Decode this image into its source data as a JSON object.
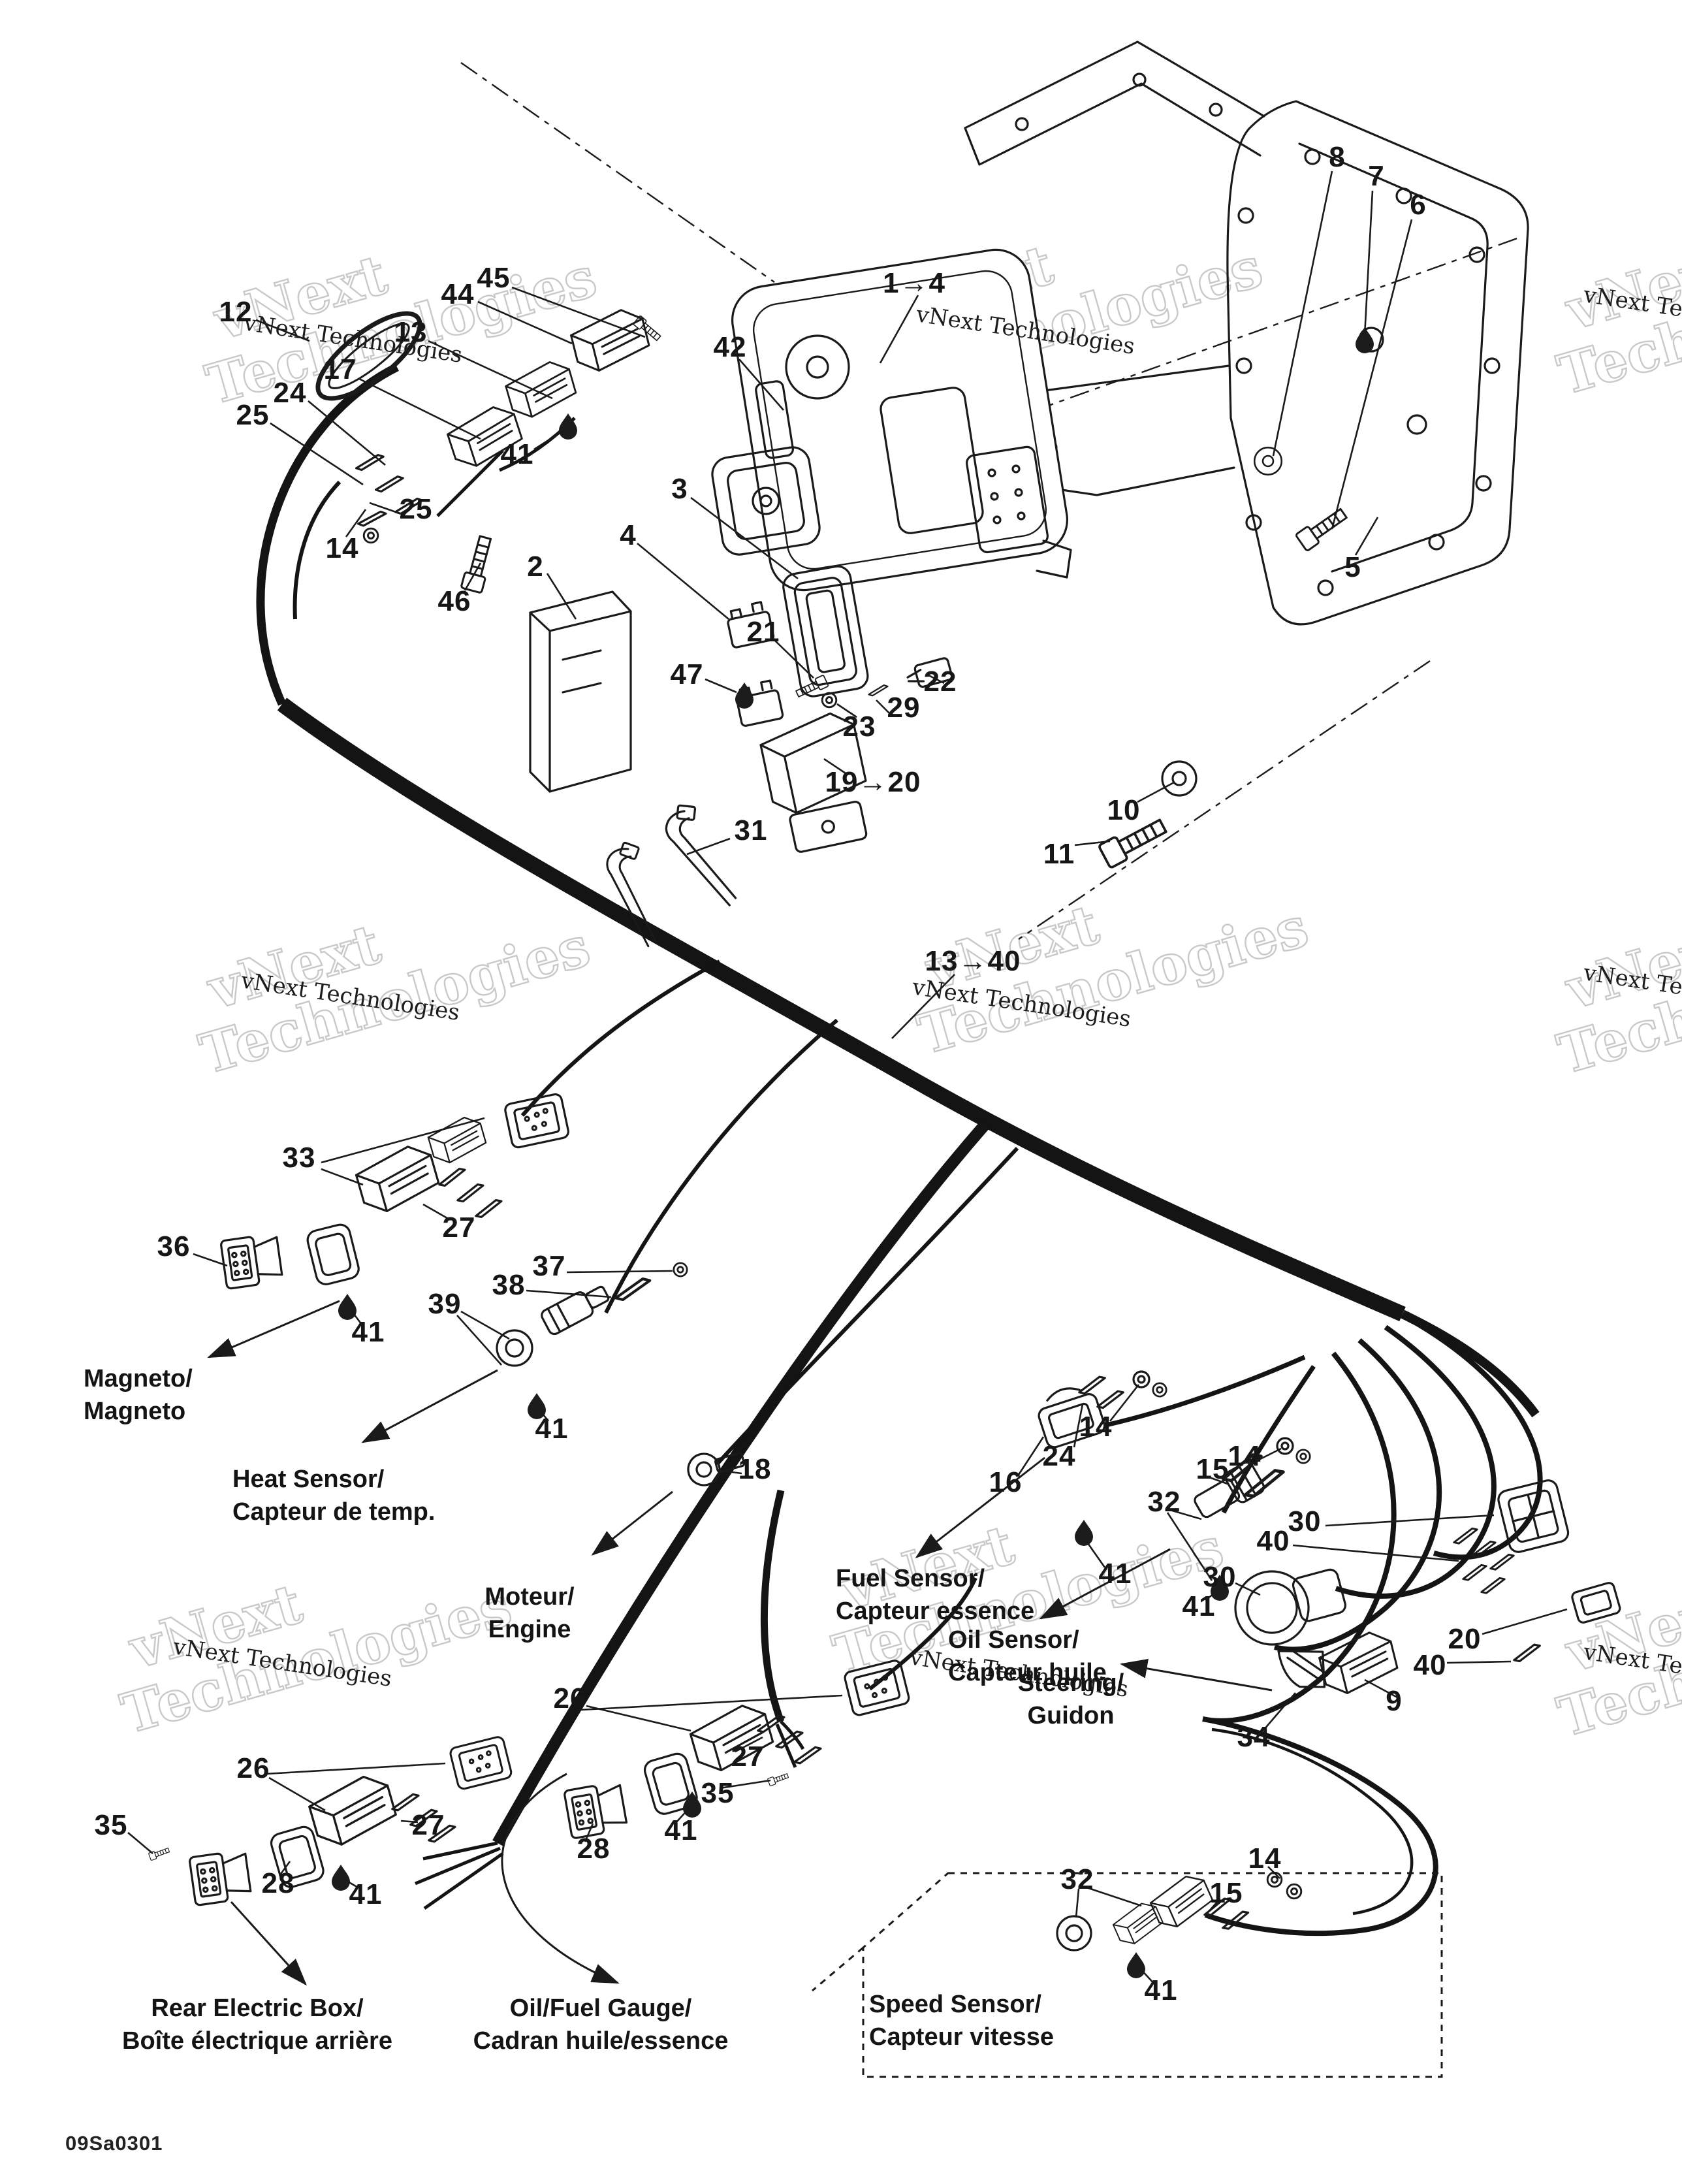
{
  "drawing_code": "09Sa0301",
  "colors": {
    "background": "#ffffff",
    "line_art": "#1a1a1a",
    "watermark": "#c9c9c9"
  },
  "watermarks": {
    "outline_line1": "vNext",
    "outline_line2": "Technologies",
    "small_text": "vNext Technologies"
  },
  "labels": {
    "magneto": {
      "line1": "Magneto/",
      "line2": "Magneto"
    },
    "heat_sensor": {
      "line1": "Heat Sensor/",
      "line2": "Capteur de temp."
    },
    "engine": {
      "line1": "Moteur/",
      "line2": "Engine"
    },
    "fuel_sensor": {
      "line1": "Fuel Sensor/",
      "line2": "Capteur essence"
    },
    "oil_sensor": {
      "line1": "Oil Sensor/",
      "line2": "Capteur huile"
    },
    "steering": {
      "line1": "Steering/",
      "line2": "Guidon"
    },
    "rear_electric_box": {
      "line1": "Rear Electric Box/",
      "line2": "Boîte électrique arrière"
    },
    "oil_fuel_gauge": {
      "line1": "Oil/Fuel Gauge/",
      "line2": "Cadran huile/essence"
    },
    "speed_sensor": {
      "line1": "Speed Sensor/",
      "line2": "Capteur vitesse"
    }
  },
  "callouts": [
    {
      "text": "12"
    },
    {
      "text": "44"
    },
    {
      "text": "45"
    },
    {
      "text": "13"
    },
    {
      "text": "17"
    },
    {
      "text": "24"
    },
    {
      "text": "25"
    },
    {
      "text": "25"
    },
    {
      "text": "14"
    },
    {
      "text": "42"
    },
    {
      "text": "41"
    },
    {
      "text": "46"
    },
    {
      "text": "2"
    },
    {
      "text": "3"
    },
    {
      "text": "4"
    },
    {
      "text": "21"
    },
    {
      "text": "47"
    },
    {
      "text": "23"
    },
    {
      "text": "29"
    },
    {
      "text": "22"
    },
    {
      "text": "19→20"
    },
    {
      "text": "10"
    },
    {
      "text": "11"
    },
    {
      "text": "31"
    },
    {
      "text": "1→4"
    },
    {
      "text": "8"
    },
    {
      "text": "7"
    },
    {
      "text": "6"
    },
    {
      "text": "5"
    },
    {
      "text": "13→40"
    },
    {
      "text": "33"
    },
    {
      "text": "27"
    },
    {
      "text": "36"
    },
    {
      "text": "41"
    },
    {
      "text": "39"
    },
    {
      "text": "38"
    },
    {
      "text": "37"
    },
    {
      "text": "41"
    },
    {
      "text": "18"
    },
    {
      "text": "14"
    },
    {
      "text": "24"
    },
    {
      "text": "16"
    },
    {
      "text": "15"
    },
    {
      "text": "14"
    },
    {
      "text": "32"
    },
    {
      "text": "30"
    },
    {
      "text": "40"
    },
    {
      "text": "41"
    },
    {
      "text": "30"
    },
    {
      "text": "41"
    },
    {
      "text": "20"
    },
    {
      "text": "40"
    },
    {
      "text": "9"
    },
    {
      "text": "34"
    },
    {
      "text": "26"
    },
    {
      "text": "27"
    },
    {
      "text": "35"
    },
    {
      "text": "41"
    },
    {
      "text": "28"
    },
    {
      "text": "26"
    },
    {
      "text": "27"
    },
    {
      "text": "35"
    },
    {
      "text": "28"
    },
    {
      "text": "41"
    },
    {
      "text": "32"
    },
    {
      "text": "14"
    },
    {
      "text": "15"
    },
    {
      "text": "41"
    }
  ]
}
